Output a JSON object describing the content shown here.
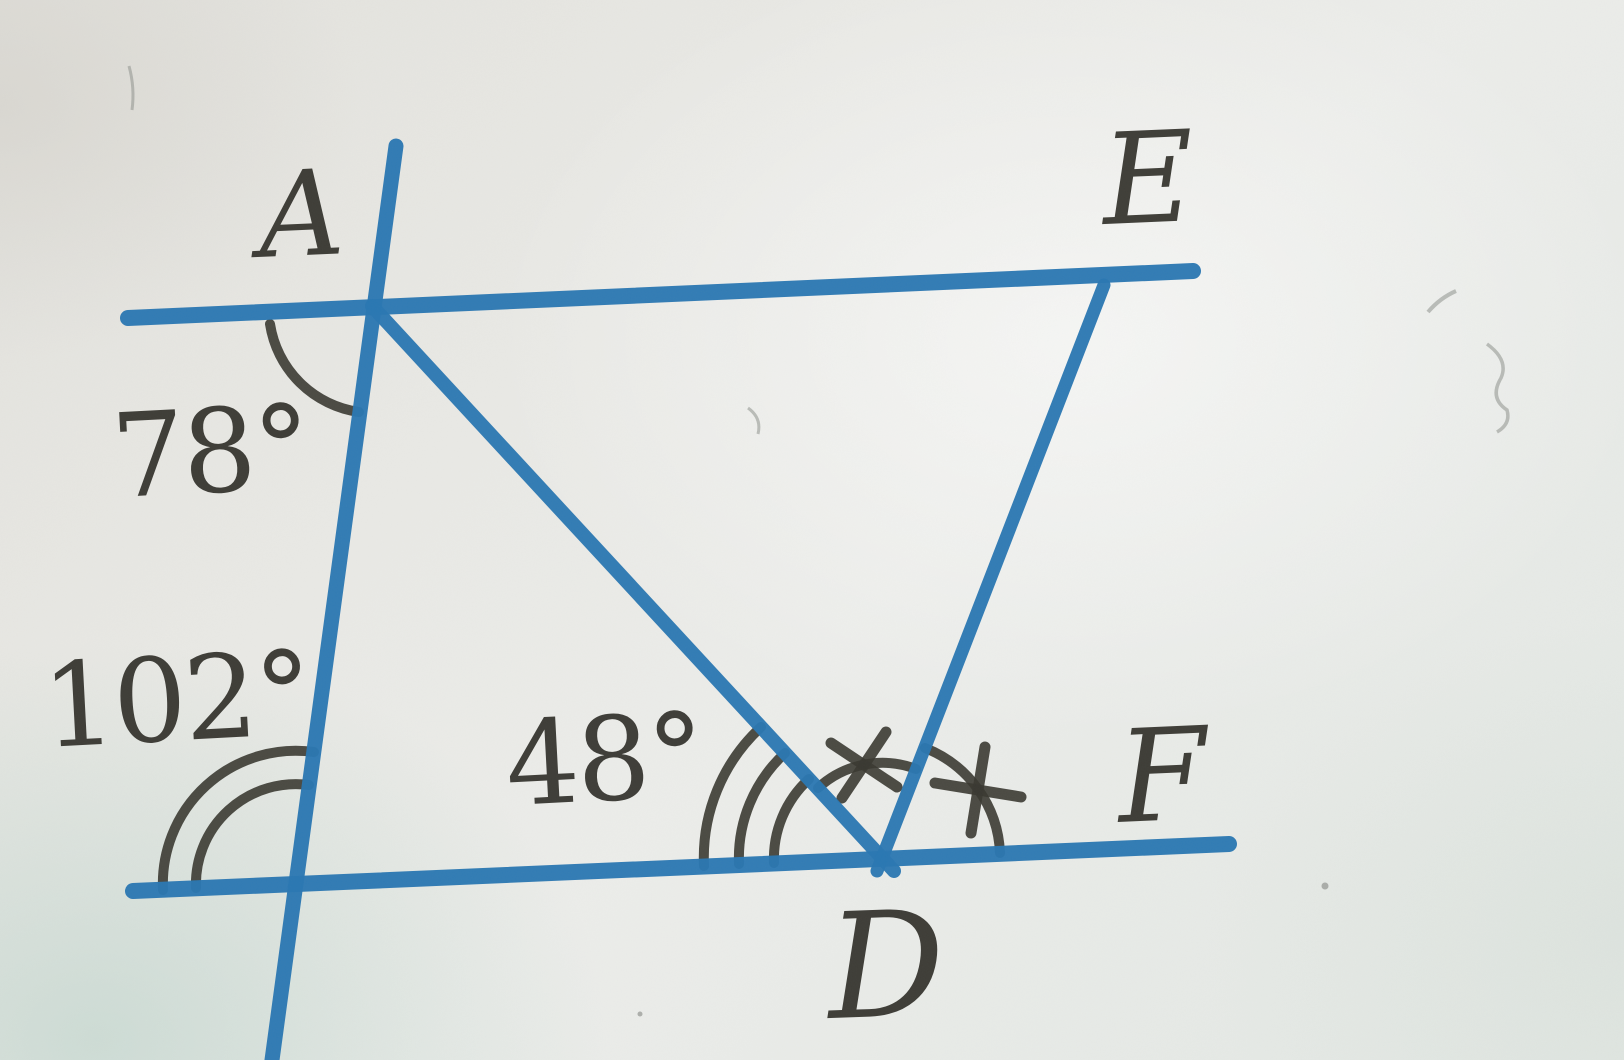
{
  "figure": {
    "kind": "geometry-diagram",
    "description": "Photographed textbook figure: two parallel lines cut by a transversal, with segments AD and ED forming a triangle vertex at D on the lower line",
    "colors": {
      "ink_blue": "#2a77b2",
      "pencil": "#3a3831",
      "paper": "#e8eae6"
    },
    "points": {
      "A": "A",
      "E": "E",
      "F": "F",
      "D": "D"
    },
    "angles": {
      "at_A": {
        "label": "78°",
        "marks": "single arc"
      },
      "at_lower_intersection": {
        "label": "102°",
        "marks": "double arc"
      },
      "at_D_left": {
        "label": "48°",
        "marks": "triple arc"
      },
      "angle_ADE": {
        "marks": "arc with cross tick"
      },
      "angle_EDF": {
        "marks": "arc with cross tick"
      }
    }
  }
}
